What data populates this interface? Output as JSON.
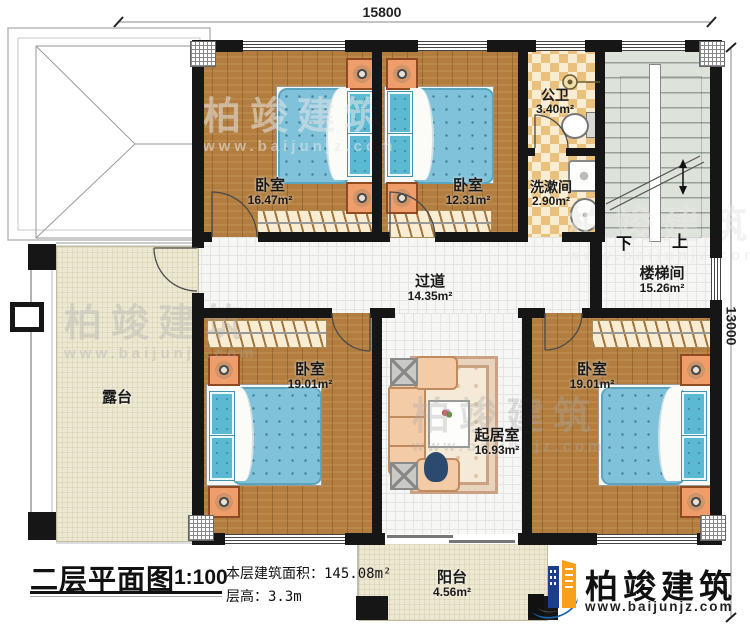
{
  "plan": {
    "dim_top": "15800",
    "dim_right": "13000",
    "rooms": {
      "bedroom_tl": {
        "name": "卧室",
        "area": "16.47m²"
      },
      "bedroom_tm": {
        "name": "卧室",
        "area": "12.31m²"
      },
      "public_bath": {
        "name": "公卫",
        "area": "3.40m²"
      },
      "washroom": {
        "name": "洗漱间",
        "area": "2.90m²"
      },
      "stairwell": {
        "name": "楼梯间",
        "area": "15.26m²"
      },
      "hallway": {
        "name": "过道",
        "area": "14.35m²"
      },
      "bedroom_bl": {
        "name": "卧室",
        "area": "19.01m²"
      },
      "living_room": {
        "name": "起居室",
        "area": "16.93m²"
      },
      "bedroom_br": {
        "name": "卧室",
        "area": "19.01m²"
      },
      "terrace": {
        "name": "露台",
        "area": ""
      },
      "balcony": {
        "name": "阳台",
        "area": "4.56m²"
      }
    },
    "stairs": {
      "down_label": "下",
      "up_label": "上"
    }
  },
  "title_block": {
    "title": "二层平面图",
    "scale": "1:100",
    "area_label": "本层建筑面积：",
    "area_value": "145.08m²",
    "floor_height_label": "层高：",
    "floor_height_value": "3.3m"
  },
  "branding": {
    "company": "柏竣建筑",
    "website": "www.baijunjz.com"
  },
  "watermark": {
    "text": "柏竣建筑",
    "url": "www.baijunjz.com"
  },
  "colors": {
    "wall": "#161616",
    "wood": "#b27d3e",
    "bath_tile": "#e9c07c",
    "bed": "#7fc2da",
    "terrace": "#ece8d2",
    "logo_blue": "#1563a8",
    "logo_orange": "#f6a01c"
  }
}
